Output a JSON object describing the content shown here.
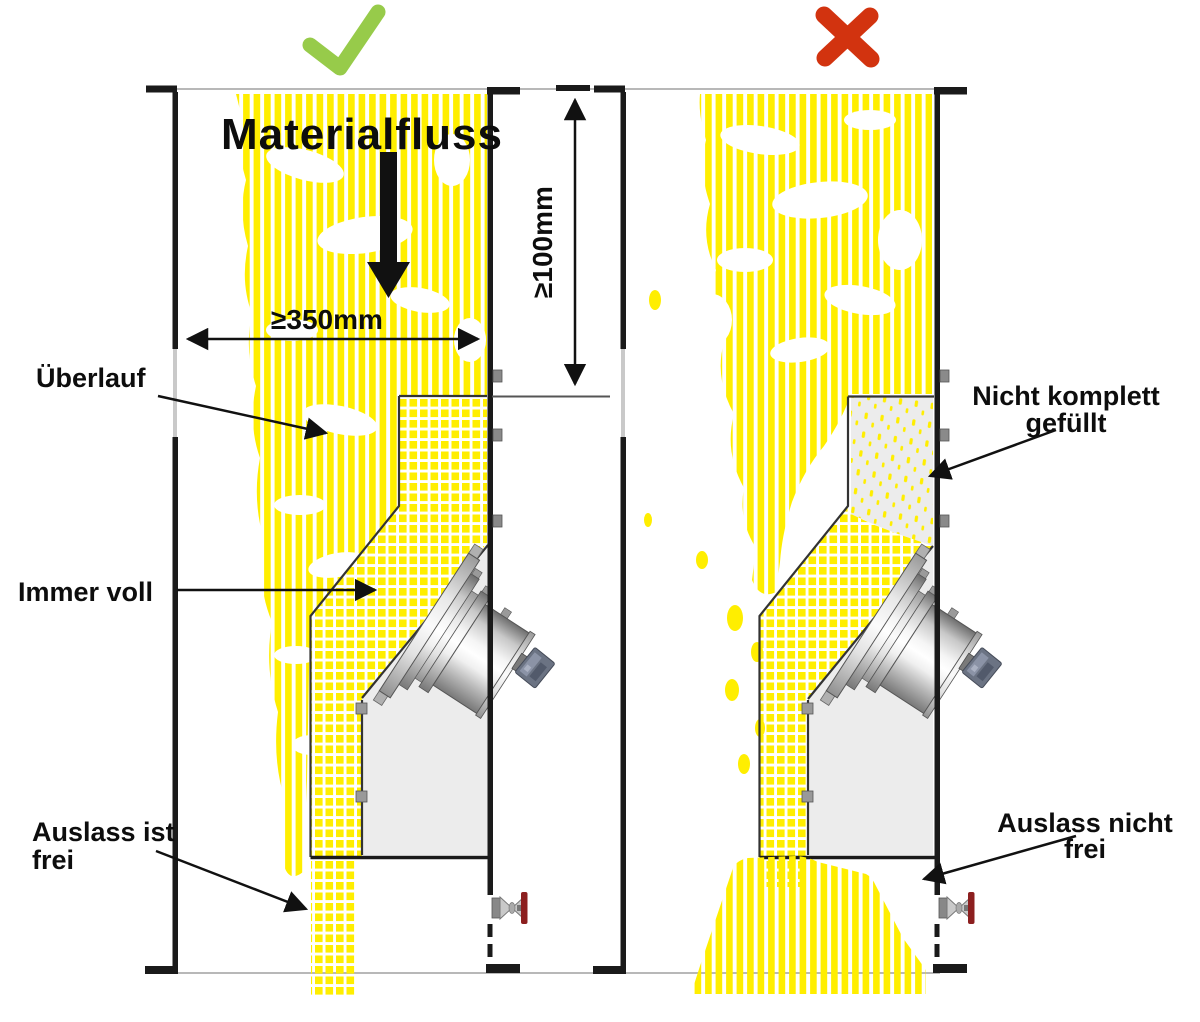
{
  "diagram": {
    "correct_panel": {
      "verdict": "correct",
      "flow_label": "Materialfluss",
      "width_dimension": "≥350mm",
      "height_dimension": "≥100mm",
      "overflow_label": "Überlauf",
      "always_full_label": "Immer voll",
      "outlet_label_line1": "Auslass ist",
      "outlet_label_line2": "frei"
    },
    "incorrect_panel": {
      "verdict": "incorrect",
      "not_filled_label_line1": "Nicht komplett",
      "not_filled_label_line2": "gefüllt",
      "outlet_label_line1": "Auslass nicht",
      "outlet_label_line2": "frei"
    },
    "colors": {
      "material_yellow": "#FFEE00",
      "check_green": "#97CB4A",
      "cross_red": "#D2330F",
      "valve_handle_red": "#8C1F1F",
      "wall_black": "#1A1A1A",
      "plate_gray": "#ECECEC"
    }
  }
}
